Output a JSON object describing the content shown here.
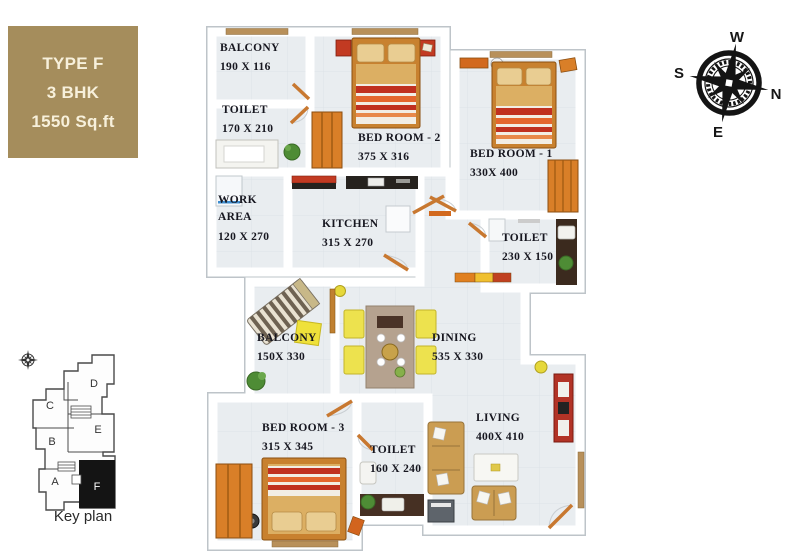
{
  "info_box": {
    "title": "TYPE F",
    "subtitle": "3 BHK",
    "area": "1550 Sq.ft"
  },
  "compass": {
    "top": "W",
    "left": "S",
    "right": "N",
    "bottom": "E"
  },
  "key_plan": {
    "caption": "Key plan",
    "units": [
      "A",
      "B",
      "C",
      "D",
      "E",
      "F"
    ],
    "highlighted_unit": "F"
  },
  "rooms": [
    {
      "id": "balcony-top",
      "name": "BALCONY",
      "dims": "190 X 116"
    },
    {
      "id": "toilet-top",
      "name": "TOILET",
      "dims": "170 X 210"
    },
    {
      "id": "bedroom-2",
      "name": "BED ROOM - 2",
      "dims": "375 X 316"
    },
    {
      "id": "bedroom-1",
      "name": "BED ROOM - 1",
      "dims": "330X 400"
    },
    {
      "id": "work-area",
      "name": "WORK AREA",
      "dims": "120 X 270"
    },
    {
      "id": "kitchen",
      "name": "KITCHEN",
      "dims": "315 X 270"
    },
    {
      "id": "toilet-mid",
      "name": "TOILET",
      "dims": "230 X 150"
    },
    {
      "id": "balcony-mid",
      "name": "BALCONY",
      "dims": "150X 330"
    },
    {
      "id": "dining",
      "name": "DINING",
      "dims": "535 X 330"
    },
    {
      "id": "bedroom-3",
      "name": "BED ROOM - 3",
      "dims": "315 X 345"
    },
    {
      "id": "toilet-bottom",
      "name": "TOILET",
      "dims": "160 X 240"
    },
    {
      "id": "living",
      "name": "LIVING",
      "dims": "400X 410"
    }
  ],
  "colors": {
    "info_box_bg": "#A58D5C",
    "wall": "#FFFFFF",
    "floor": "#E9EDF0",
    "wood_orange": "#D97F28",
    "accent_red": "#C23A22",
    "chair_yellow": "#EDE24E",
    "plant_green": "#4E8C35"
  }
}
